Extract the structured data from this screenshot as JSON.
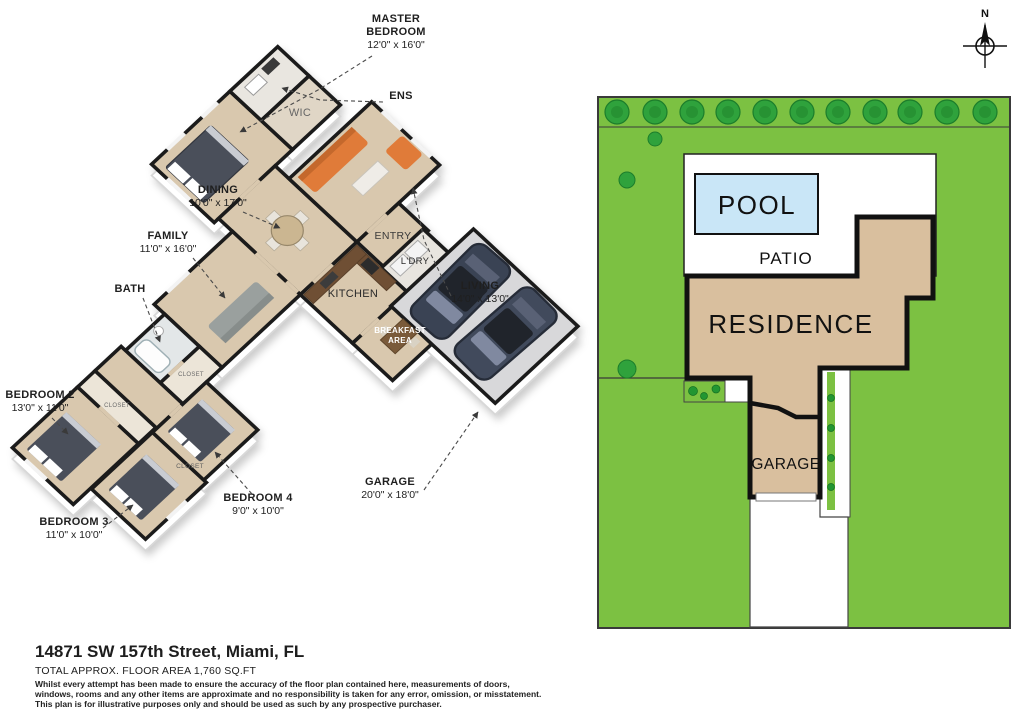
{
  "floor_plan": {
    "labels": [
      {
        "id": "master-bedroom",
        "lines": [
          "MASTER",
          "BEDROOM"
        ],
        "dims": "12'0\" x 16'0\"",
        "x": 396,
        "y": 22,
        "leader": "M372,56 L318,90 L240,132"
      },
      {
        "id": "ens",
        "lines": [
          "ENS"
        ],
        "dims": "",
        "x": 401,
        "y": 99,
        "leader": "M383,102 L320,100 L282,88"
      },
      {
        "id": "dining",
        "lines": [
          "DINING"
        ],
        "dims": "10'0\" x 17'0\"",
        "x": 218,
        "y": 193,
        "leader": "M243,212 L280,228"
      },
      {
        "id": "family",
        "lines": [
          "FAMILY"
        ],
        "dims": "11'0\" x 16'0\"",
        "x": 168,
        "y": 239,
        "leader": "M193,258 L225,298"
      },
      {
        "id": "bath",
        "lines": [
          "BATH"
        ],
        "dims": "",
        "x": 130,
        "y": 292,
        "leader": "M143,298 L160,342"
      },
      {
        "id": "living",
        "lines": [
          "LIVING"
        ],
        "dims": "14'0\" x 13'0\"",
        "x": 480,
        "y": 289,
        "leader": "M451,296 L424,240 L413,188"
      },
      {
        "id": "bedroom-2",
        "lines": [
          "BEDROOM 2"
        ],
        "dims": "13'0\" x 11'0\"",
        "x": 40,
        "y": 398,
        "leader": "M52,418 L68,434"
      },
      {
        "id": "bedroom-3",
        "lines": [
          "BEDROOM 3"
        ],
        "dims": "11'0\" x 10'0\"",
        "x": 74,
        "y": 525,
        "leader": "M103,528 L133,505"
      },
      {
        "id": "bedroom-4",
        "lines": [
          "BEDROOM 4"
        ],
        "dims": "9'0\" x 10'0\"",
        "x": 258,
        "y": 501,
        "leader": "M252,494 L215,452"
      },
      {
        "id": "garage",
        "lines": [
          "GARAGE"
        ],
        "dims": "20'0\" x 18'0\"",
        "x": 390,
        "y": 485,
        "leader": "M424,490 L478,412"
      }
    ],
    "room_texts": [
      {
        "id": "wic",
        "text": "WIC",
        "x": 300,
        "y": 116,
        "size": 11,
        "color": "#666666",
        "weight": "400"
      },
      {
        "id": "entry",
        "text": "ENTRY",
        "x": 393,
        "y": 239,
        "size": 10.5,
        "color": "#3a3a3a",
        "weight": "400"
      },
      {
        "id": "kitchen",
        "text": "KITCHEN",
        "x": 353,
        "y": 297,
        "size": 11,
        "color": "#2a2a2a",
        "weight": "400"
      },
      {
        "id": "ldry",
        "text": "L'DRY",
        "x": 415,
        "y": 264,
        "size": 9.5,
        "color": "#2a2a2a",
        "weight": "400"
      },
      {
        "id": "breakfast-1",
        "text": "BREAKFAST",
        "x": 400,
        "y": 333,
        "size": 8,
        "color": "#ffffff",
        "weight": "700"
      },
      {
        "id": "breakfast-2",
        "text": "AREA",
        "x": 400,
        "y": 343,
        "size": 8,
        "color": "#ffffff",
        "weight": "700"
      },
      {
        "id": "closet-1",
        "text": "CLOSET",
        "x": 191,
        "y": 376,
        "size": 6,
        "color": "#6b6b6b",
        "weight": "400"
      },
      {
        "id": "closet-2",
        "text": "CLOSET",
        "x": 117,
        "y": 407,
        "size": 6,
        "color": "#6b6b6b",
        "weight": "400"
      },
      {
        "id": "closet-3",
        "text": "CLOSET",
        "x": 190,
        "y": 468,
        "size": 6.5,
        "color": "#5f5f5f",
        "weight": "400"
      }
    ]
  },
  "site_plan": {
    "pool": "POOL",
    "patio": "PATIO",
    "residence": "RESIDENCE",
    "garage": "GARAGE"
  },
  "compass": {
    "north": "N"
  },
  "footer": {
    "address": "14871 SW 157th Street, Miami, FL",
    "area": "TOTAL APPROX. FLOOR AREA 1,760 SQ.FT",
    "disclaimer": [
      "Whilst every attempt has been made to ensure the accuracy of the floor plan contained here, measurements of doors,",
      "windows, rooms and any other items are approximate and no responsibility is taken for any error, omission, or misstatement.",
      "This plan is for illustrative purposes only and should be used as such by any prospective purchaser."
    ]
  },
  "colors": {
    "lot_green": "#7cc142",
    "tree_green": "#2fa23c",
    "residence_tan": "#d9bf9e",
    "pool_blue": "#c9e6f7",
    "floor_tan": "#d9c8ae",
    "sofa_orange": "#e07b39",
    "wall_black": "#1b1b1b"
  }
}
